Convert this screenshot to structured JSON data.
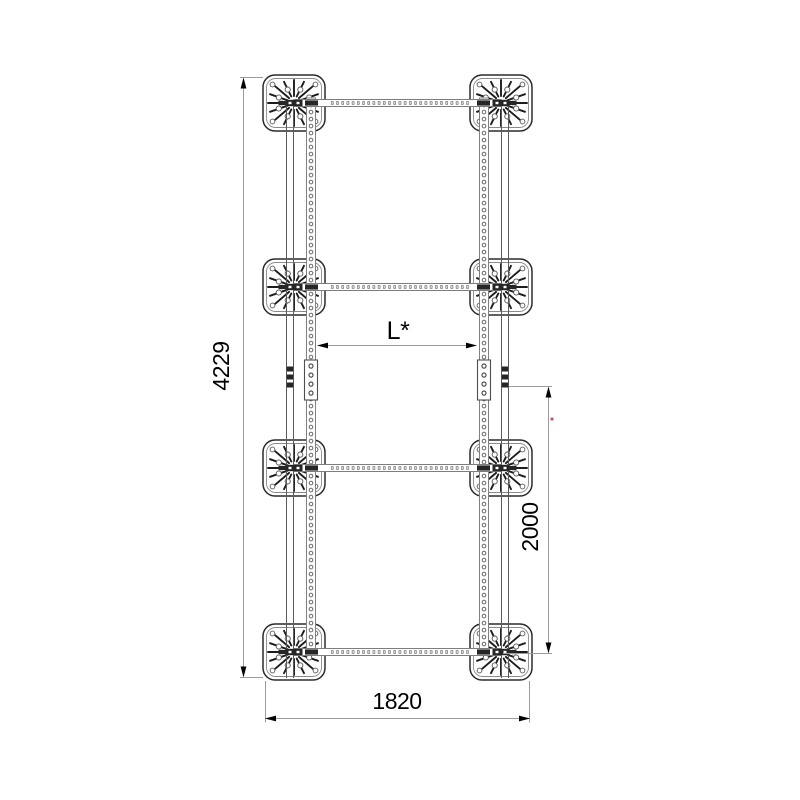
{
  "dimensions": {
    "height_total": {
      "label": "4229"
    },
    "span_variable": {
      "label": "L*"
    },
    "span_lower": {
      "label": "2000"
    },
    "width_total": {
      "label": "1820"
    }
  },
  "colors": {
    "background": "#ffffff",
    "line_dark": "#2b2b2b",
    "line_gray": "#808080",
    "dimension_line": "#9c9c9c",
    "arrow_fill": "#000000",
    "marker_red": "#b4606a"
  },
  "structure": {
    "plate_rows": 4,
    "plate_columns": 2,
    "plates_total": 8,
    "cross_beams": 4,
    "vertical_rails_per_side": 2
  }
}
